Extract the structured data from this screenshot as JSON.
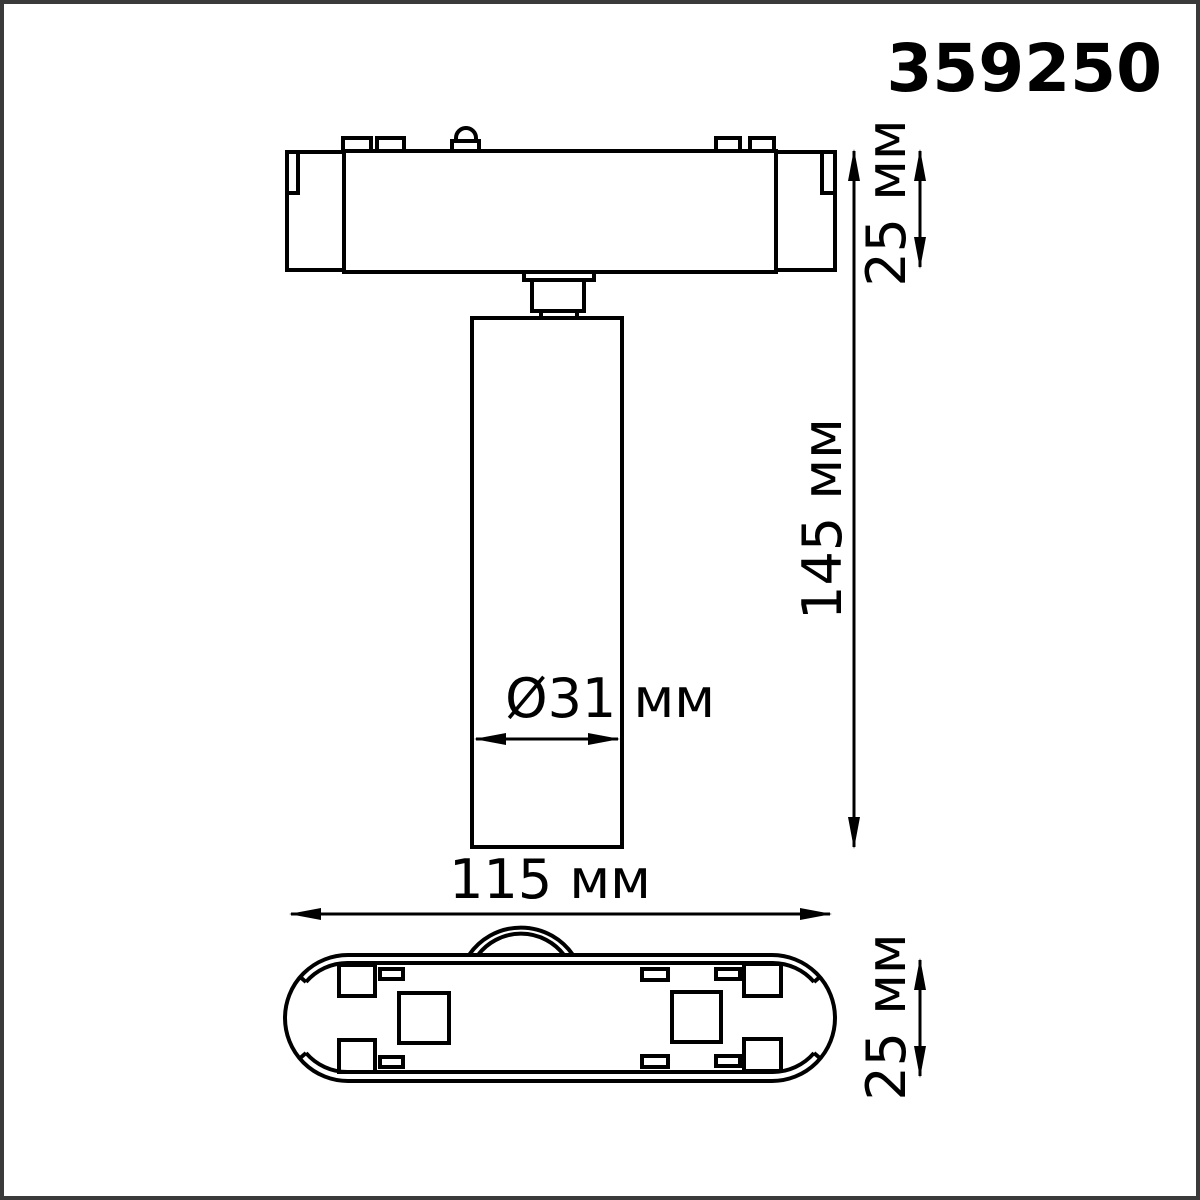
{
  "part_number": "359250",
  "unit": "мм",
  "views": {
    "front": {
      "dims": {
        "track_height": "25 мм",
        "total_height": "145 мм",
        "lamp_diameter": "Ø31 мм"
      }
    },
    "bottom": {
      "dims": {
        "track_length": "115 мм",
        "track_width": "25 мм"
      }
    }
  },
  "colors": {
    "line": "#000000",
    "background": "#ffffff",
    "frame": "#3a3a3a"
  }
}
